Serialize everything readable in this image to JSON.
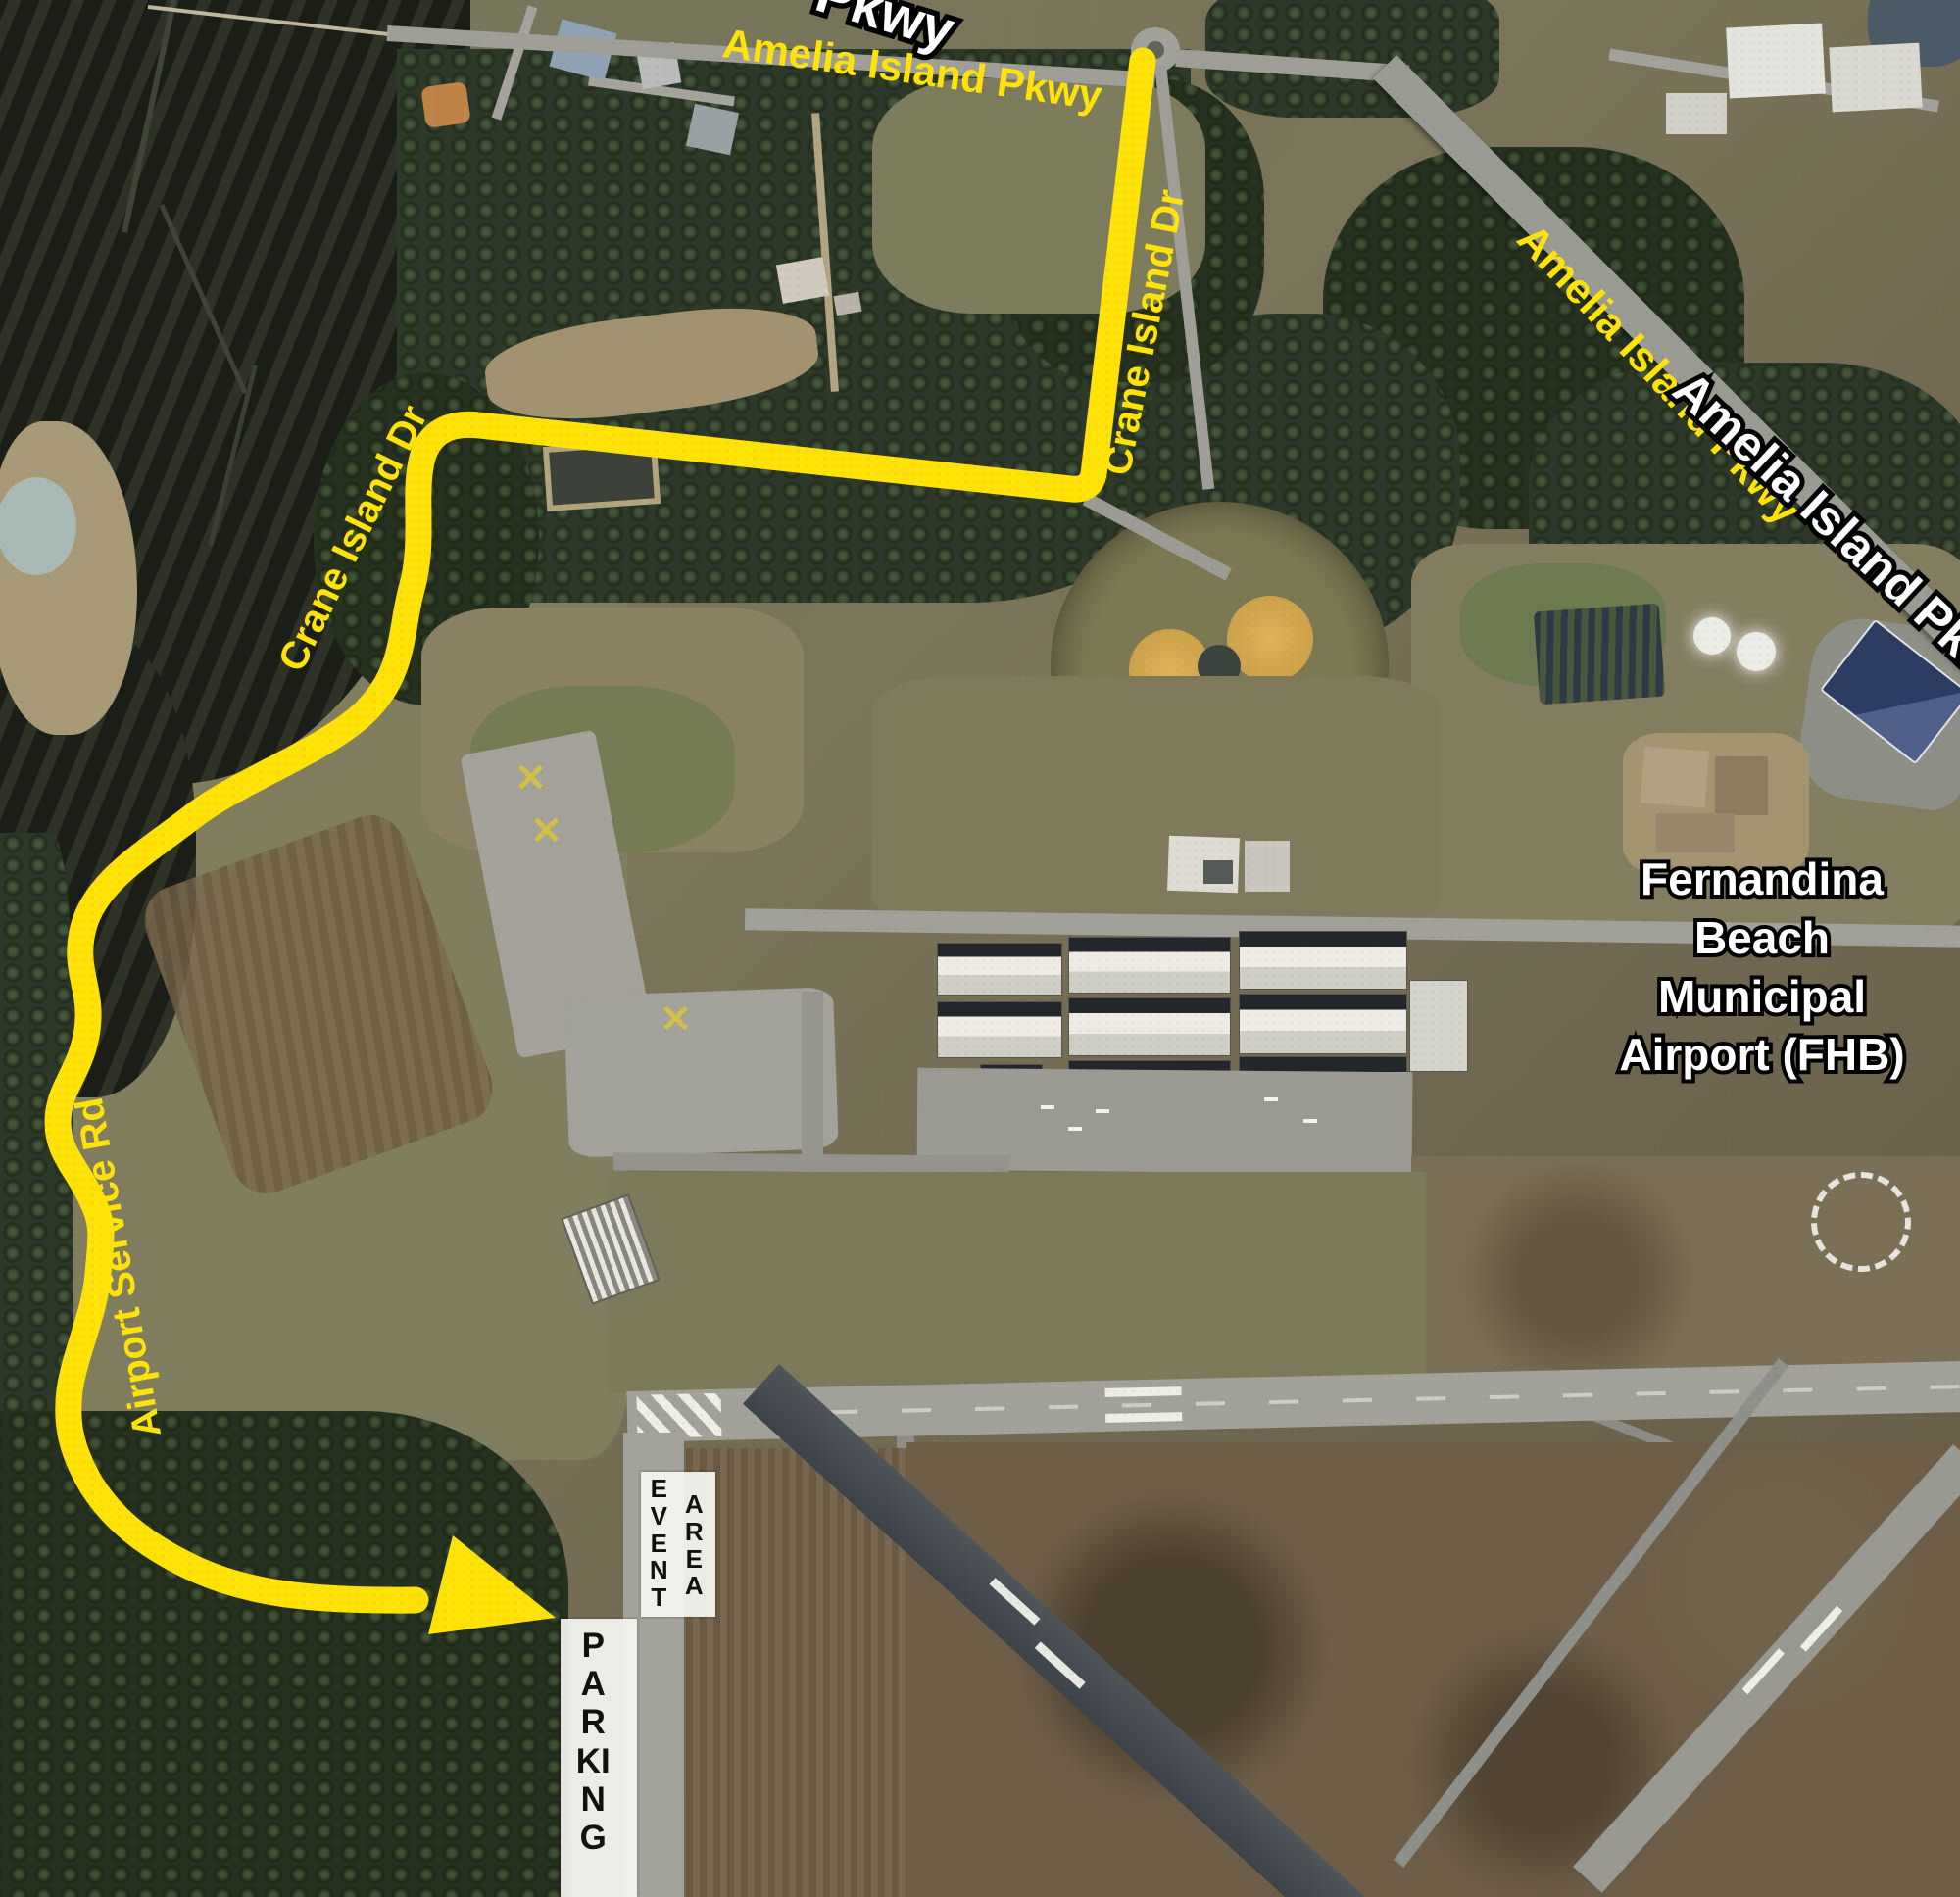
{
  "title": "Airport event driving route map",
  "colors": {
    "route_yellow": "#ffe308",
    "label_white": "#ffffff",
    "label_outline": "#000000"
  },
  "labels": {
    "amelia_top": "Amelia Island Pkwy",
    "pkwy_partial": "Pkwy",
    "amelia_diag_yellow": "Amelia Island Pkwy",
    "amelia_diag_white": "Amelia Island Pkwy",
    "crane_right": "Crane Island Dr",
    "crane_left": "Crane Island Dr",
    "airport_service": "Airport Service Rd",
    "airport_name": "Fernandina\nBeach\nMunicipal\nAirport (FHB)",
    "event": "EVENT",
    "area": "AREA",
    "parking": "PARKING"
  }
}
